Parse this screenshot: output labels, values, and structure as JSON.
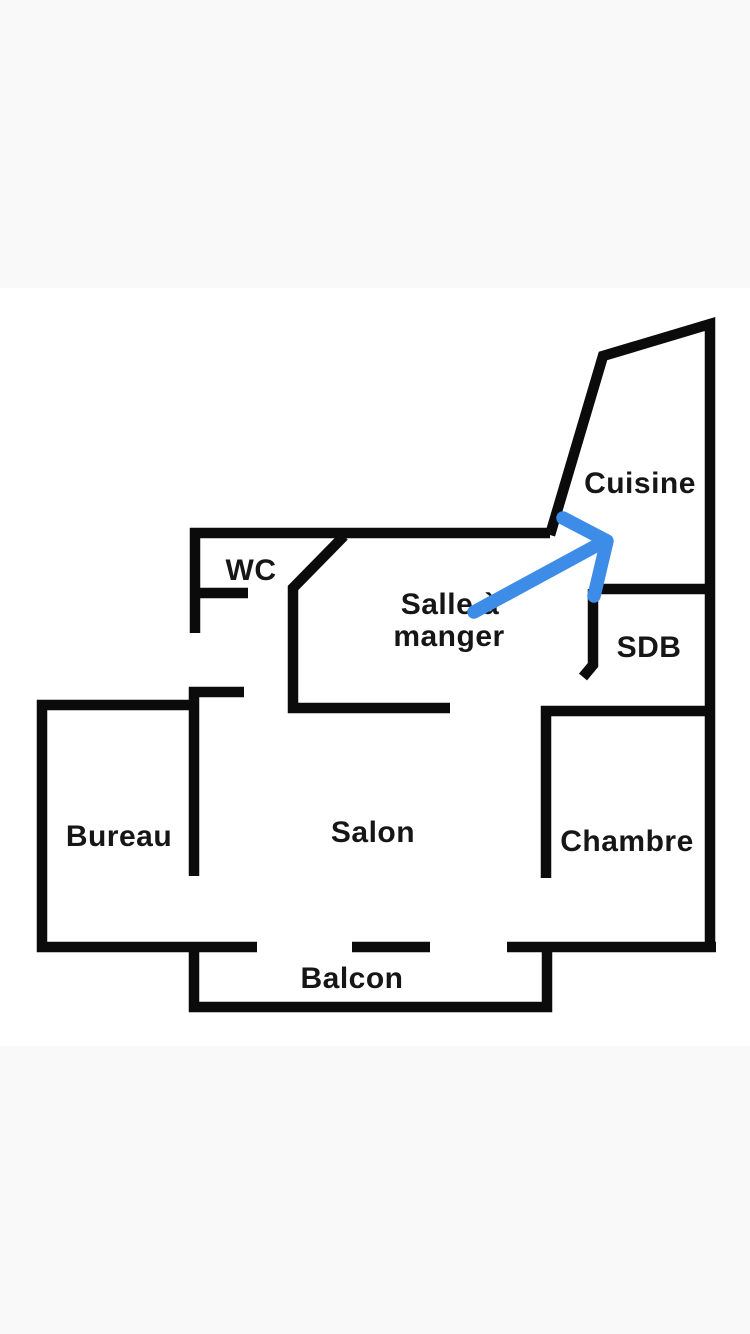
{
  "screen": {
    "width": 750,
    "height": 1334
  },
  "colors": {
    "wall": "#0b0b0b",
    "label": "#161616",
    "arrow": "#3d8ce8",
    "backdrop_band": "#f9f9f9",
    "plan_background": "#ffffff"
  },
  "floor_plan": {
    "rooms": {
      "cuisine": {
        "label": "Cuisine"
      },
      "wc": {
        "label": "WC"
      },
      "salle_a_manger": {
        "label": "Salle à manger",
        "label_line1": "Salle à",
        "label_line2": "manger"
      },
      "sdb": {
        "label": "SDB"
      },
      "bureau": {
        "label": "Bureau"
      },
      "salon": {
        "label": "Salon"
      },
      "chambre": {
        "label": "Chambre"
      },
      "balcon": {
        "label": "Balcon"
      }
    }
  },
  "annotation": {
    "arrow_color": "#3d8ce8"
  }
}
